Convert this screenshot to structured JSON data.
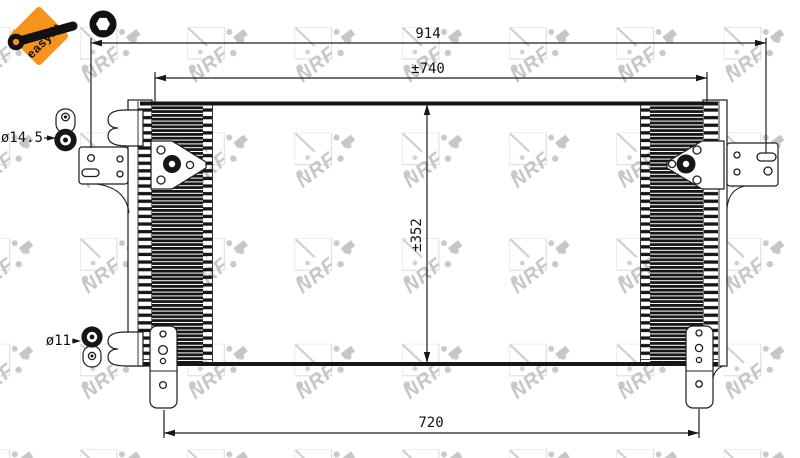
{
  "badge": {
    "label": "easyfit",
    "bg_color": "#F6921E",
    "text_color": "#111111"
  },
  "watermark": {
    "text": "NRF",
    "color": "#c6c6c6"
  },
  "dimensions": {
    "overall_width": {
      "label": "914"
    },
    "core_width": {
      "label": "±740"
    },
    "core_height": {
      "label": "±352"
    },
    "mounting_width": {
      "label": "720"
    }
  },
  "fittings": {
    "top_port": {
      "label": "ø14.5"
    },
    "bottom_port": {
      "label": "ø11"
    }
  },
  "drawing": {
    "line_color": "#1d1d1b",
    "fin_color": "#161616"
  }
}
